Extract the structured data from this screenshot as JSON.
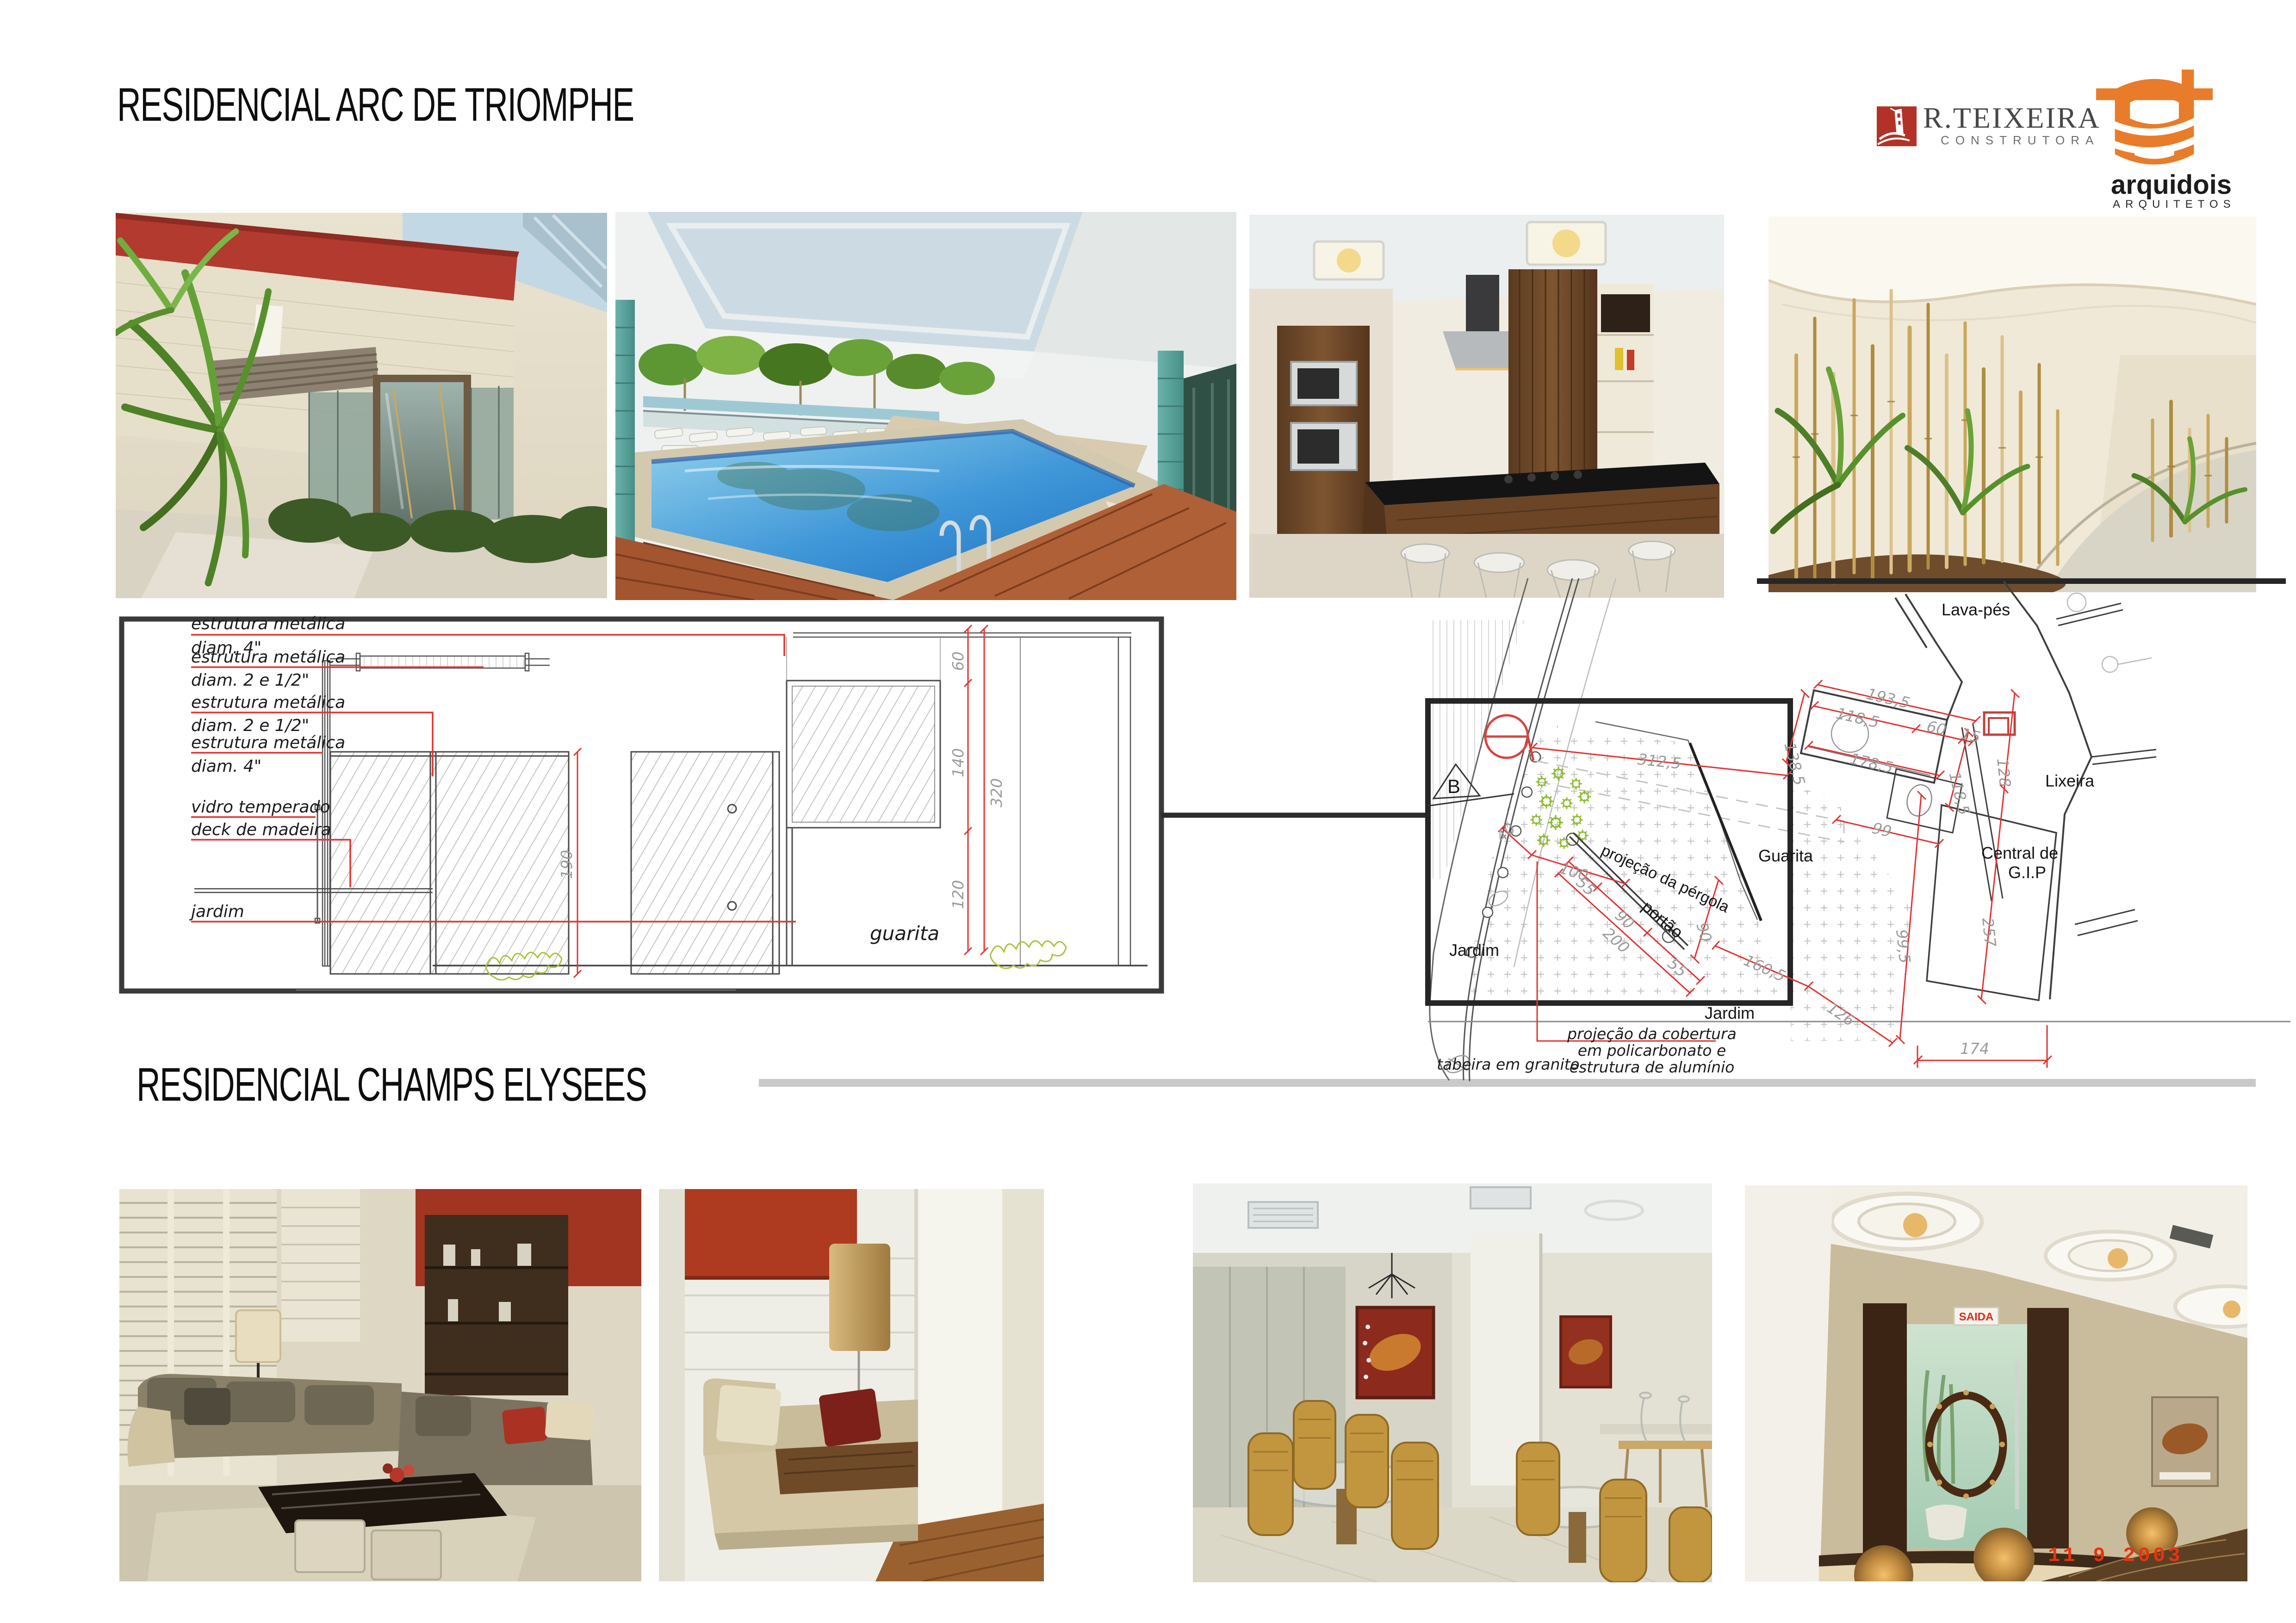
{
  "header": {
    "title": "RESIDENCIAL ARC DE TRIOMPHE"
  },
  "section2": {
    "title": "RESIDENCIAL CHAMPS ELYSEES"
  },
  "logos": {
    "rteixeira": {
      "name": "R.TEIXEIRA",
      "subtitle": "CONSTRUTORA",
      "accent": "#b23227"
    },
    "arquidois": {
      "name": "arquidois",
      "subtitle": "ARQUITETOS",
      "accent": "#e87c2a"
    }
  },
  "section_drawing": {
    "caption": "guarita",
    "labels": [
      {
        "l1": "estrutura metálica",
        "l2": "diam. 4\""
      },
      {
        "l1": "estrutura metálica",
        "l2": "diam. 2 e 1/2\""
      },
      {
        "l1": "estrutura metálica",
        "l2": "diam. 2 e 1/2\""
      },
      {
        "l1": "estrutura metálica",
        "l2": "diam. 4\""
      },
      {
        "l1": "vidro temperado",
        "l2": ""
      },
      {
        "l1": "deck de madeira",
        "l2": ""
      },
      {
        "l1": "jardim",
        "l2": ""
      }
    ],
    "dims": {
      "d60": "60",
      "d140": "140",
      "d320": "320",
      "d120": "120",
      "d190": "190"
    }
  },
  "site_plan": {
    "rooms": {
      "lavapes": "Lava-pés",
      "lixeira": "Lixeira",
      "central1": "Central de",
      "central2": "G.I.P",
      "guarita": "Guarita",
      "jardim_left": "Jardim",
      "jardim_right": "Jardim",
      "portao": "portão",
      "pergola": "projeção da pérgola"
    },
    "marker": "B",
    "notes": {
      "cobertura1": "projeção da cobertura",
      "cobertura2": "em policarbonato e",
      "cobertura3": "estrutura de alumínio",
      "tabeira": "tabeira em granito"
    },
    "dims": {
      "d3125": "312,5",
      "d40": "40",
      "d100": "100",
      "d55a": "55",
      "d90a": "90",
      "d200": "200",
      "d55b": "55",
      "d90b": "90",
      "d1605": "160,5",
      "d126": "126",
      "d1935": "193,5",
      "d1185a": "118,5",
      "d60": "60",
      "d15": "15",
      "d1385": "138,5",
      "d1785": "178,5",
      "d1185b": "118,5",
      "d128": "128",
      "d99": "99",
      "d995": "99,5",
      "d257": "257",
      "d174": "174"
    }
  },
  "photos": {
    "saida_sign": "SAIDA",
    "date_stamp": "11  9  2003"
  },
  "colors": {
    "dim_red": "#e03432",
    "dim_gray": "#9b9b9b",
    "frame_black": "#2b2b2b",
    "plant_green": "#9cc23b",
    "rule_gray": "#c9c9c9"
  }
}
